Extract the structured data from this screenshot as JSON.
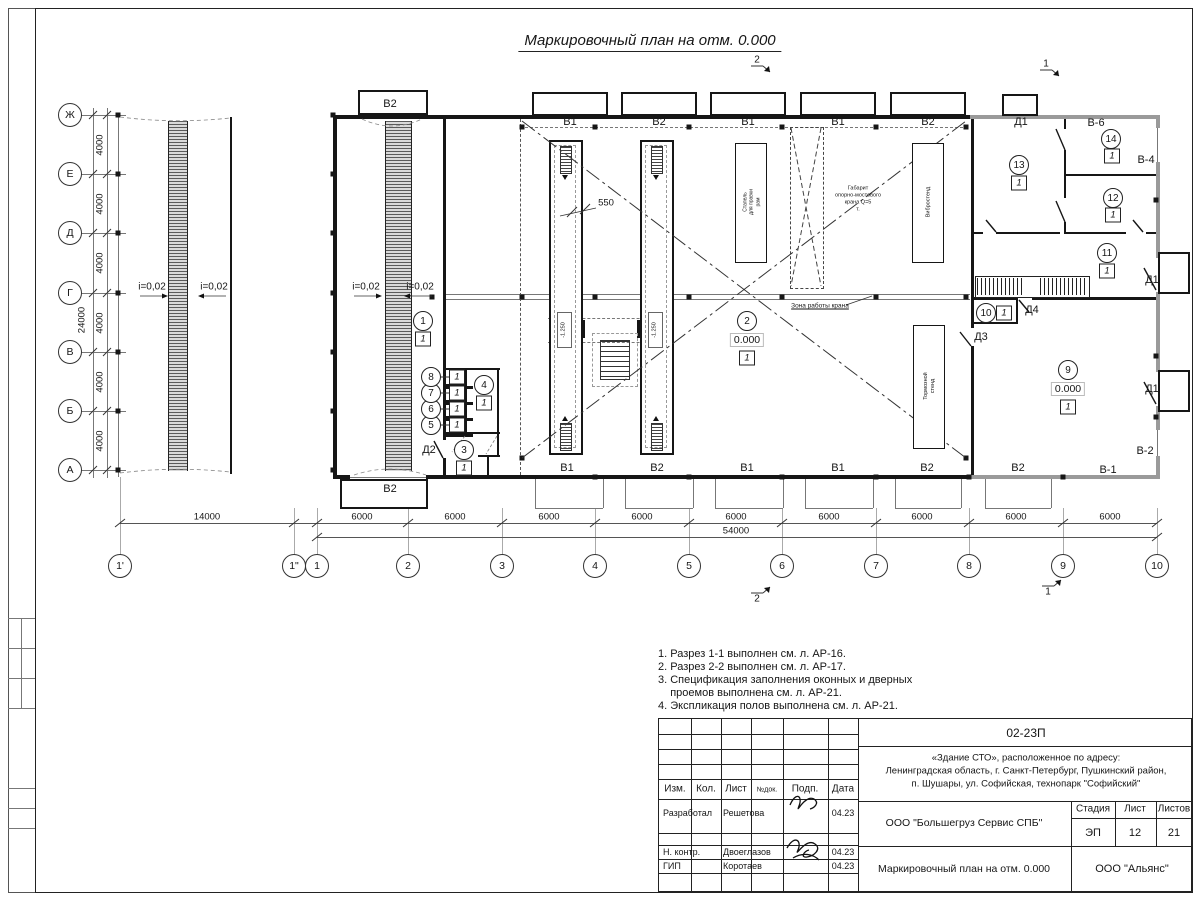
{
  "sheet": {
    "title": "Маркировочный план на отм. 0.000"
  },
  "axes": {
    "rows": [
      "Ж",
      "Е",
      "Д",
      "Г",
      "В",
      "Б",
      "А"
    ],
    "row_dim": "4000",
    "row_total": "24000",
    "cols": [
      "1'",
      "1\"",
      "1",
      "2",
      "3",
      "4",
      "5",
      "6",
      "7",
      "8",
      "9",
      "10"
    ],
    "col_first_dim": "14000",
    "col_dim": "6000",
    "col_total": "54000"
  },
  "slope_text": "i=0,02",
  "slopes": [
    {
      "x": 152,
      "y": 287,
      "dir": "r"
    },
    {
      "x": 214,
      "y": 287,
      "dir": "l"
    },
    {
      "x": 366,
      "y": 287,
      "dir": "r"
    },
    {
      "x": 420,
      "y": 287,
      "dir": "l"
    }
  ],
  "wall_labels": [
    {
      "t": "В2",
      "x": 390,
      "y": 104
    },
    {
      "t": "В1",
      "x": 570,
      "y": 122
    },
    {
      "t": "В2",
      "x": 659,
      "y": 122
    },
    {
      "t": "В1",
      "x": 748,
      "y": 122
    },
    {
      "t": "В1",
      "x": 838,
      "y": 122
    },
    {
      "t": "В2",
      "x": 928,
      "y": 122
    },
    {
      "t": "Д1",
      "x": 1021,
      "y": 122
    },
    {
      "t": "В-6",
      "x": 1096,
      "y": 123
    },
    {
      "t": "В-4",
      "x": 1146,
      "y": 160
    },
    {
      "t": "В2",
      "x": 390,
      "y": 489
    },
    {
      "t": "В1",
      "x": 567,
      "y": 468
    },
    {
      "t": "В2",
      "x": 657,
      "y": 468
    },
    {
      "t": "В1",
      "x": 747,
      "y": 468
    },
    {
      "t": "В1",
      "x": 838,
      "y": 468
    },
    {
      "t": "В2",
      "x": 927,
      "y": 468
    },
    {
      "t": "В2",
      "x": 1018,
      "y": 468
    },
    {
      "t": "В-1",
      "x": 1108,
      "y": 470
    },
    {
      "t": "В-2",
      "x": 1145,
      "y": 451
    },
    {
      "t": "Д2",
      "x": 429,
      "y": 450
    },
    {
      "t": "Д3",
      "x": 981,
      "y": 337
    },
    {
      "t": "Д4",
      "x": 1032,
      "y": 310
    },
    {
      "t": "Д1",
      "x": 1152,
      "y": 280
    },
    {
      "t": "Д1",
      "x": 1152,
      "y": 389
    }
  ],
  "room_tags": [
    {
      "n": "1",
      "x": 423,
      "y": 321,
      "bx": 423,
      "by": 339
    },
    {
      "n": "2",
      "x": 747,
      "y": 321,
      "elev": "0.000",
      "ex": 747,
      "ey": 340,
      "bx": 747,
      "by": 358
    },
    {
      "n": "3",
      "x": 464,
      "y": 450,
      "bx": 464,
      "by": 468
    },
    {
      "n": "4",
      "x": 484,
      "y": 385,
      "bx": 484,
      "by": 403
    },
    {
      "n": "5",
      "x": 431,
      "y": 425,
      "bx": 457,
      "by": 425
    },
    {
      "n": "6",
      "x": 431,
      "y": 409,
      "bx": 457,
      "by": 409
    },
    {
      "n": "7",
      "x": 431,
      "y": 393,
      "bx": 457,
      "by": 393
    },
    {
      "n": "8",
      "x": 431,
      "y": 377,
      "bx": 457,
      "by": 377
    },
    {
      "n": "9",
      "x": 1068,
      "y": 370,
      "elev": "0.000",
      "ex": 1068,
      "ey": 389,
      "bx": 1068,
      "by": 407
    },
    {
      "n": "10",
      "x": 986,
      "y": 313,
      "bx": 1004,
      "by": 313
    },
    {
      "n": "11",
      "x": 1107,
      "y": 253,
      "bx": 1107,
      "by": 271
    },
    {
      "n": "12",
      "x": 1113,
      "y": 198,
      "bx": 1113,
      "by": 215
    },
    {
      "n": "13",
      "x": 1019,
      "y": 165,
      "bx": 1019,
      "by": 183
    },
    {
      "n": "14",
      "x": 1111,
      "y": 139,
      "bx": 1112,
      "by": 156
    }
  ],
  "equipment": {
    "stapel": "Стапель\nдля правки\nрам",
    "vibro": "Вибростенд",
    "tormoz": "Тормозной\nстенд",
    "crane": "Габарит\nопорно-мостового\nкрана Q=5\nт.",
    "zone": "Зона работы крана"
  },
  "marks": {
    "pit_width": "550",
    "pit_elev": "-1.250"
  },
  "section_marks": [
    {
      "n": "2",
      "x": 757,
      "y": 60,
      "dir": "d"
    },
    {
      "n": "1",
      "x": 1046,
      "y": 64,
      "dir": "d"
    },
    {
      "n": "2",
      "x": 757,
      "y": 599,
      "dir": "u"
    },
    {
      "n": "1",
      "x": 1048,
      "y": 592,
      "dir": "u"
    }
  ],
  "notes": [
    "1. Разрез 1-1 выполнен см. л. АР-16.",
    "2. Разрез 2-2 выполнен см. л. АР-17.",
    "3. Спецификация заполнения оконных и дверных",
    "    проемов выполнена см. л. АР-21.",
    "4. Экспликация полов выполнена см. л. АР-21."
  ],
  "stamp": {
    "doc_no": "02-23П",
    "object_lines": [
      "«Здание СТО», расположенное по адресу:",
      "Ленинградская область, г. Санкт-Петербург, Пушкинский район,",
      "п. Шушары, ул. Софийская, технопарк \"Софийский\""
    ],
    "col_izm": "Изм.",
    "col_kol": "Кол.",
    "col_list": "Лист",
    "col_ndok": "№док.",
    "col_podp": "Подп.",
    "col_data": "Дата",
    "rows": [
      {
        "role": "Разработал",
        "name": "Решетова",
        "date": "04.23"
      },
      {
        "role": "Н. контр.",
        "name": "Двоеглазов",
        "date": "04.23"
      },
      {
        "role": "ГИП",
        "name": "Коротаев",
        "date": "04.23"
      }
    ],
    "org": "ООО \"Большегруз Сервис СПБ\"",
    "stage_label": "Стадия",
    "sheet_label": "Лист",
    "sheets_label": "Листов",
    "stage": "ЭП",
    "sheet": "12",
    "sheets": "21",
    "plan_title": "Маркировочный план на отм. 0.000",
    "contractor": "ООО \"Альянс\""
  }
}
